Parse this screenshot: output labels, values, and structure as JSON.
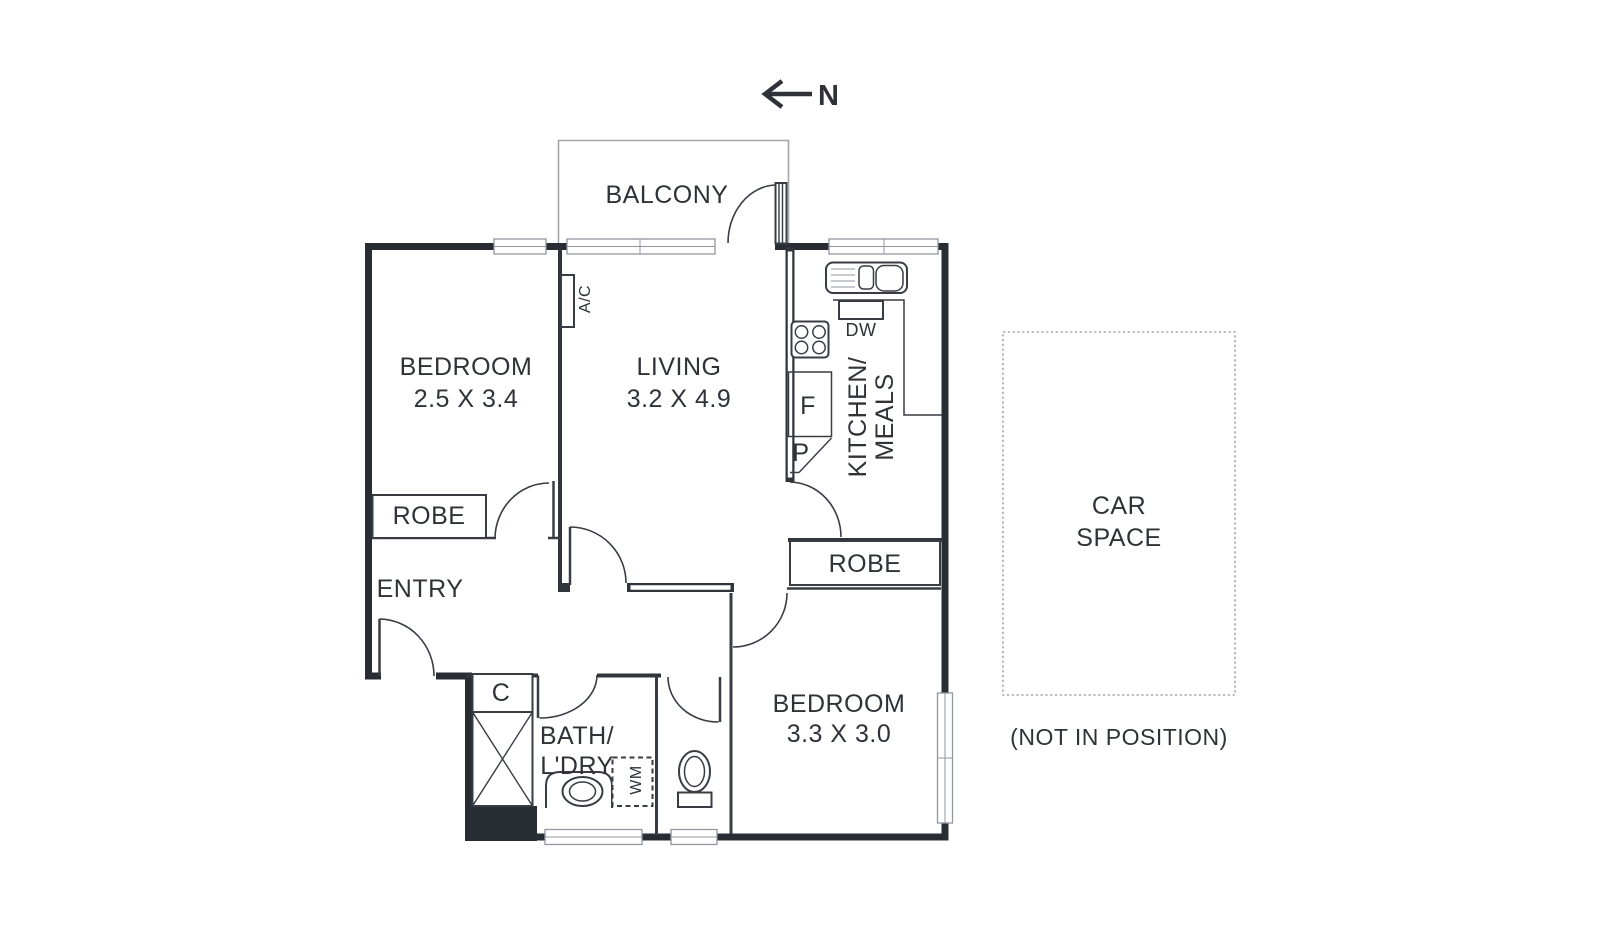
{
  "colors": {
    "background": "#ffffff",
    "wall": "#282c33",
    "wall2": "#30343b",
    "line": "#383c43",
    "text": "#2f3237",
    "window_border": "#9096a0",
    "light_outline": "#a6a6a6"
  },
  "compass": {
    "label": "N"
  },
  "rooms": {
    "balcony": {
      "label": "BALCONY"
    },
    "bedroom1": {
      "label": "BEDROOM",
      "dims": "2.5 X 3.4",
      "robe_label": "ROBE"
    },
    "living": {
      "label": "LIVING",
      "dims": "3.2 X 4.9"
    },
    "kitchen": {
      "label_line1": "KITCHEN/",
      "label_line2": "MEALS",
      "dw_label": "DW",
      "fridge_label": "F",
      "pantry_label": "P"
    },
    "entry": {
      "label": "ENTRY"
    },
    "bedroom2": {
      "label": "BEDROOM",
      "dims": "3.3 X 3.0",
      "robe_label": "ROBE"
    },
    "bath": {
      "label_line1": "BATH/",
      "label_line2": "L'DRY",
      "wm_label": "WM"
    },
    "cupboard": {
      "label": "C"
    },
    "ac": {
      "label": "A/C"
    },
    "car_space": {
      "label_line1": "CAR",
      "label_line2": "SPACE",
      "note": "(NOT IN POSITION)"
    }
  }
}
